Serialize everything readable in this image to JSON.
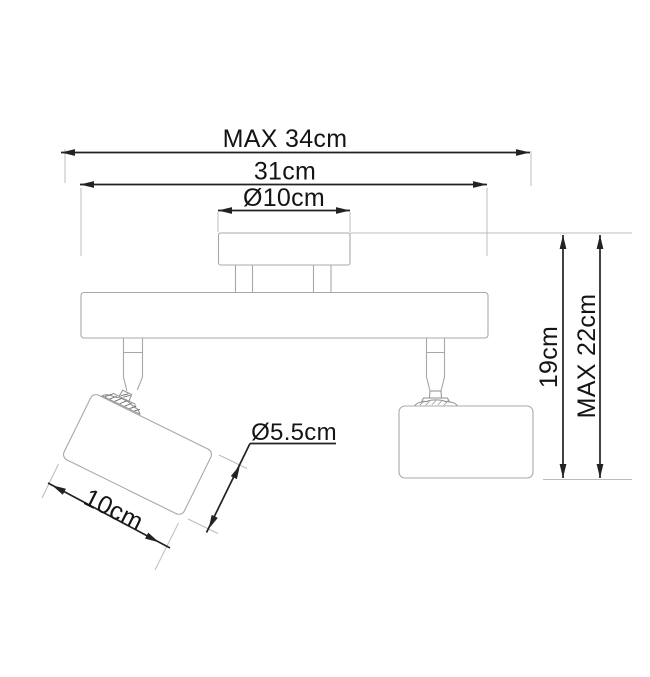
{
  "diagram": {
    "type": "technical-drawing",
    "subject": "ceiling spotlight track with two adjustable cylindrical spot heads",
    "colors": {
      "background": "#ffffff",
      "product_outline": "#a8a8a8",
      "dimension_lines": "#222222",
      "extension_lines": "#bcbcbc",
      "label_text": "#141414"
    },
    "dimensions": {
      "max_width": "MAX 34cm",
      "track_width": "31cm",
      "canopy_diameter": "Ø10cm",
      "height": "19cm",
      "max_height": "MAX 22cm",
      "spot_diameter": "Ø5.5cm",
      "spot_length": "10cm"
    }
  }
}
